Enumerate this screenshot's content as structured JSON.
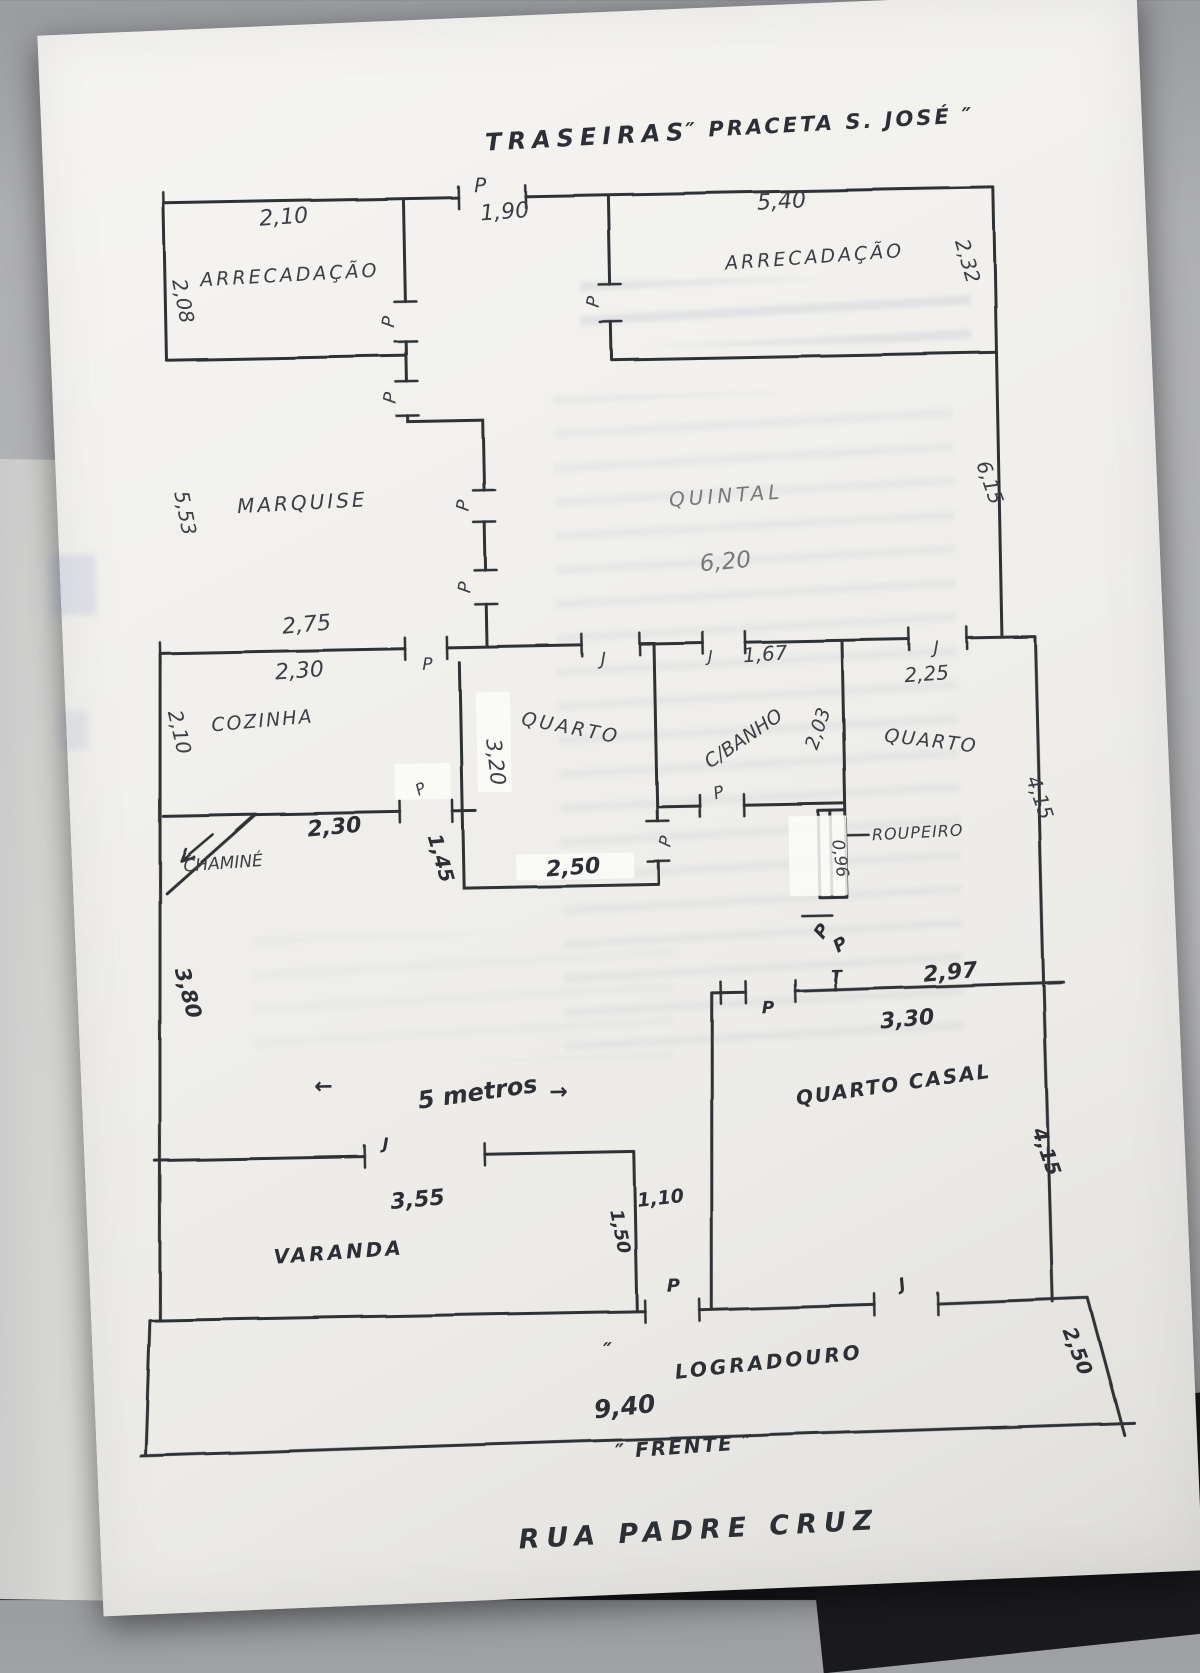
{
  "plan": {
    "orientation": {
      "back": "TRASEIRAS",
      "back_square": "″ PRACETA S. JOSÉ ″",
      "front": "″ FRENTE ″",
      "street": "RUA PADRE CRUZ"
    },
    "markers": {
      "door": "P",
      "window": "J",
      "swing": "T",
      "arrow_left": "←",
      "arrow_right": "→",
      "ditto": "″",
      "note_5m": "5 metros"
    },
    "rooms": {
      "arrecadacao_left": "ARRECADAÇÃO",
      "arrecadacao_right": "ARRECADAÇÃO",
      "marquise": "MARQUISE",
      "quintal": "QUINTAL",
      "cozinha": "COZINHA",
      "quarto_mid": "QUARTO",
      "banho": "C/BANHO",
      "quarto_right": "QUARTO",
      "chamine": "CHAMINÉ",
      "roupeiro": "ROUPEIRO",
      "quarto_casal": "QUARTO CASAL",
      "varanda": "VARANDA",
      "logradouro": "LOGRADOURO"
    },
    "dims": {
      "arr_left_w": "2,10",
      "arr_door": "1,90",
      "arr_right_w": "5,40",
      "arr_left_h": "2,08",
      "arr_right_h": "2,32",
      "marquise_h": "5,53",
      "quintal_w": "6,20",
      "quintal_h": "6,15",
      "band_top": "2,75",
      "cozinha_w": "2,30",
      "banho_window": "1,67",
      "quarto_right_window": "2,25",
      "cozinha_h": "2,10",
      "quarto_mid_h": "3,20",
      "banho_h": "2,03",
      "chamine_wall": "2,30",
      "quarto_door_side": "1,45",
      "quarto_mid_w": "2,50",
      "roupeiro_w": "0,96",
      "quarto_right_h": "4,15",
      "sala_h": "3,80",
      "casal_top": "2,97",
      "casal_top2": "3,30",
      "casal_h": "4,15",
      "varanda_window": "3,55",
      "corridor_w": "1,10",
      "corridor_l": "1,50",
      "logradouro_h": "2,50",
      "front_w": "9,40"
    }
  }
}
